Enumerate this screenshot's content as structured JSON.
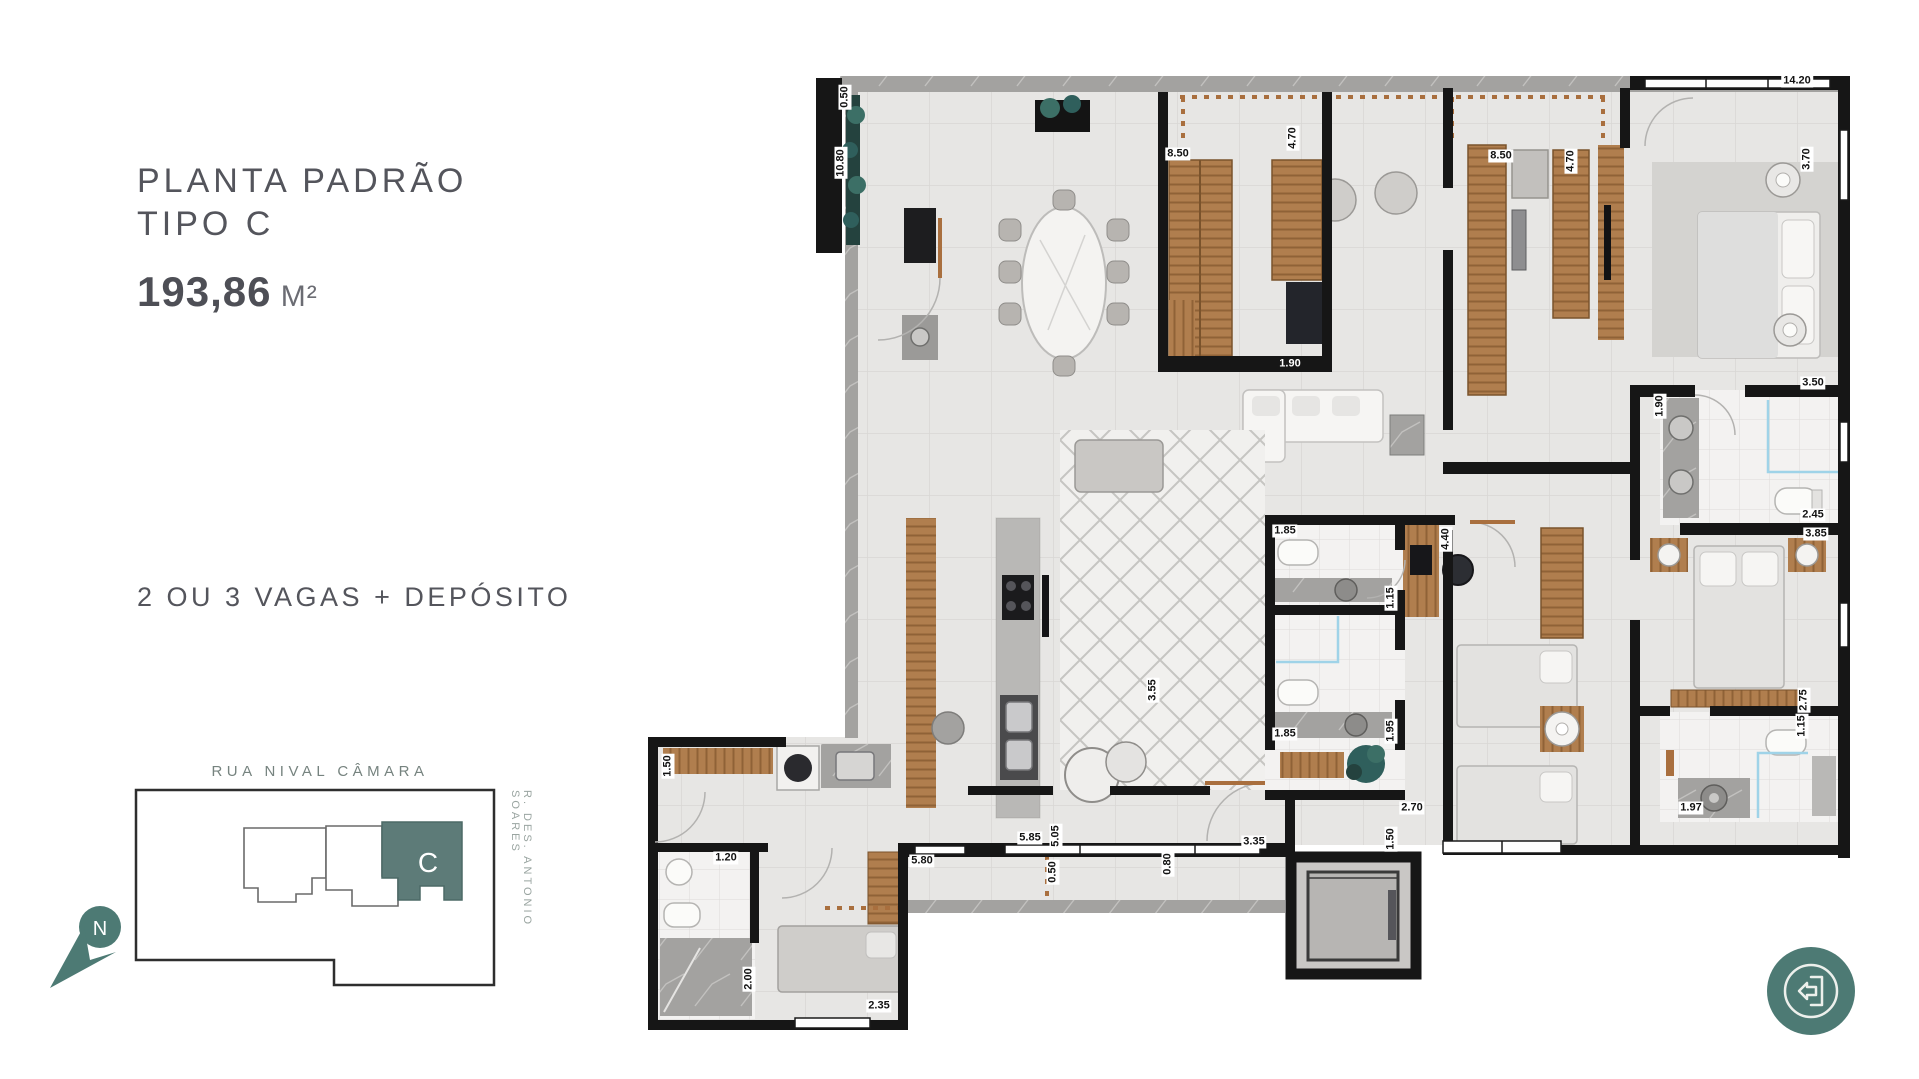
{
  "left_panel": {
    "title": "PLANTA PADRÃO\nTIPO C",
    "area_value": "193,86",
    "area_unit": " M²",
    "parking_text": "2 OU 3 VAGAS + DEPÓSITO"
  },
  "site_plan": {
    "street_top": "RUA NIVAL CÂMARA",
    "street_right": "R. DES. ANTONIO SOARES",
    "unit_label": "C",
    "north_label": "N",
    "accent_color": "#4d7a74",
    "unit_fill": "#5d7b78"
  },
  "floor_plan": {
    "dimension_labels": [
      {
        "text": "14.20",
        "x": 1797,
        "y": 81
      },
      {
        "text": "0.50",
        "x": 845,
        "y": 97,
        "cls": "v"
      },
      {
        "text": "10.80",
        "x": 841,
        "y": 163,
        "cls": "v"
      },
      {
        "text": "8.50",
        "x": 1178,
        "y": 154
      },
      {
        "text": "4.70",
        "x": 1293,
        "y": 138,
        "cls": "v"
      },
      {
        "text": "8.50",
        "x": 1501,
        "y": 156
      },
      {
        "text": "4.70",
        "x": 1571,
        "y": 161,
        "cls": "v"
      },
      {
        "text": "3.70",
        "x": 1807,
        "y": 159,
        "cls": "v"
      },
      {
        "text": "1.90",
        "x": 1290,
        "y": 364,
        "cls": "inv"
      },
      {
        "text": "3.50",
        "x": 1813,
        "y": 383
      },
      {
        "text": "1.90",
        "x": 1660,
        "y": 406,
        "cls": "v"
      },
      {
        "text": "2.45",
        "x": 1813,
        "y": 515
      },
      {
        "text": "3.85",
        "x": 1816,
        "y": 534
      },
      {
        "text": "1.85",
        "x": 1285,
        "y": 531
      },
      {
        "text": "1.15",
        "x": 1391,
        "y": 598,
        "cls": "v"
      },
      {
        "text": "4.40",
        "x": 1446,
        "y": 539,
        "cls": "v"
      },
      {
        "text": "1.85",
        "x": 1285,
        "y": 734
      },
      {
        "text": "1.95",
        "x": 1391,
        "y": 731,
        "cls": "v"
      },
      {
        "text": "3.55",
        "x": 1153,
        "y": 690,
        "cls": "v"
      },
      {
        "text": "2.70",
        "x": 1412,
        "y": 808
      },
      {
        "text": "1.50",
        "x": 1391,
        "y": 839,
        "cls": "v"
      },
      {
        "text": "2.75",
        "x": 1804,
        "y": 700,
        "cls": "v"
      },
      {
        "text": "1.15",
        "x": 1802,
        "y": 726,
        "cls": "v"
      },
      {
        "text": "1.97",
        "x": 1691,
        "y": 808
      },
      {
        "text": "5.85",
        "x": 1030,
        "y": 838
      },
      {
        "text": "5.05",
        "x": 1056,
        "y": 836,
        "cls": "v"
      },
      {
        "text": "3.35",
        "x": 1254,
        "y": 842
      },
      {
        "text": "0.80",
        "x": 1168,
        "y": 864,
        "cls": "v"
      },
      {
        "text": "0.50",
        "x": 1053,
        "y": 872,
        "cls": "v"
      },
      {
        "text": "5.80",
        "x": 922,
        "y": 861
      },
      {
        "text": "1.50",
        "x": 668,
        "y": 766,
        "cls": "v"
      },
      {
        "text": "1.20",
        "x": 726,
        "y": 858
      },
      {
        "text": "2.00",
        "x": 749,
        "y": 979,
        "cls": "v"
      },
      {
        "text": "2.35",
        "x": 879,
        "y": 1006
      }
    ]
  },
  "back_button": {
    "color": "#4d7a74"
  }
}
